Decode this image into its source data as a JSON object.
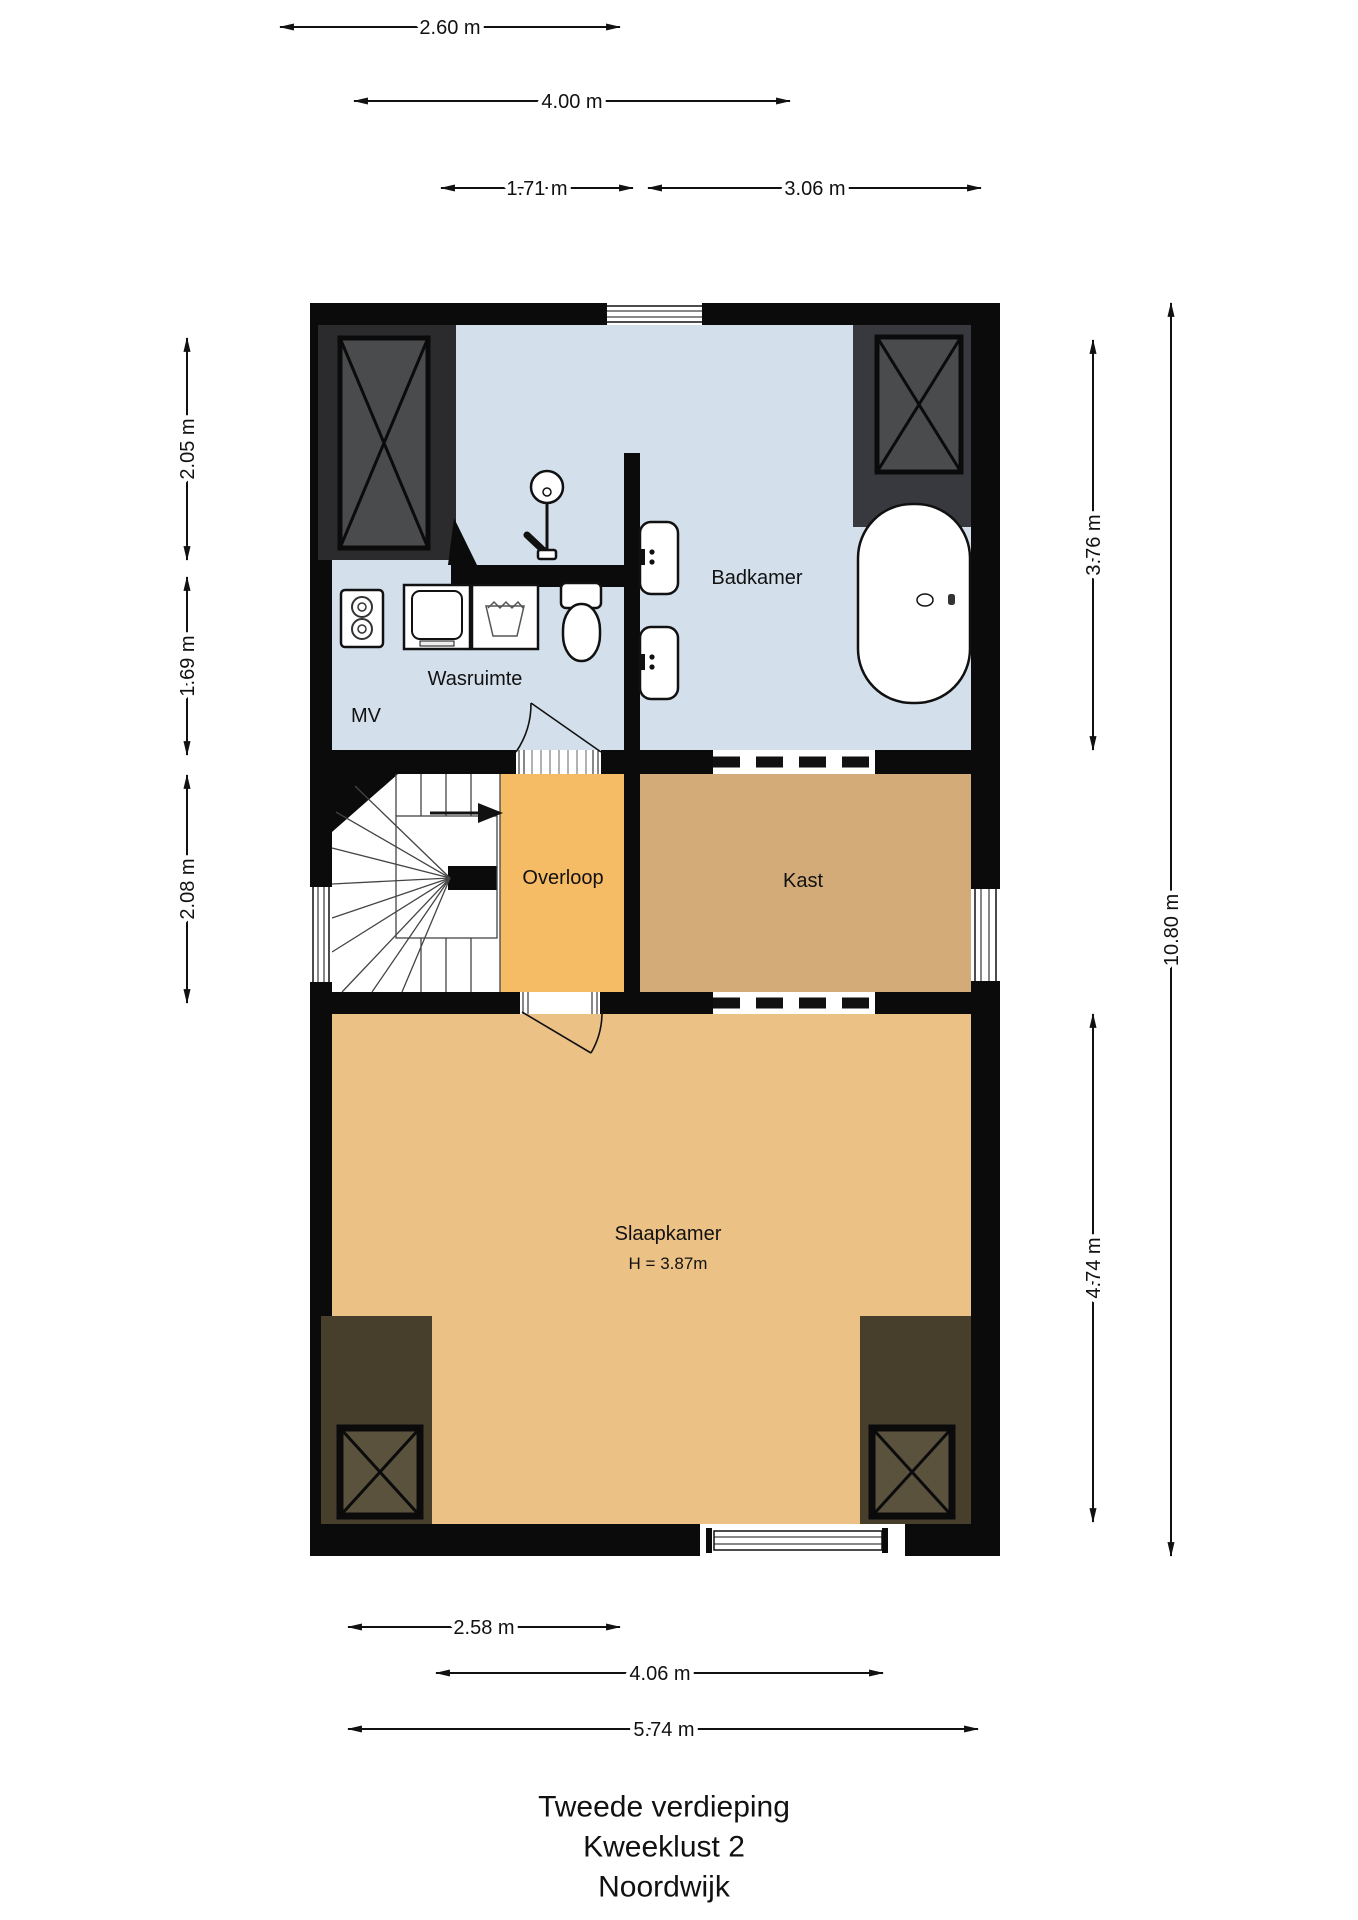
{
  "title": {
    "line1": "Tweede verdieping",
    "line2": "Kweeklust 2",
    "line3": "Noordwijk"
  },
  "rooms": {
    "badkamer": {
      "label": "Badkamer"
    },
    "wasruimte": {
      "label": "Wasruimte"
    },
    "mv": {
      "label": "MV"
    },
    "overloop": {
      "label": "Overloop"
    },
    "kast": {
      "label": "Kast"
    },
    "slaapkamer": {
      "label": "Slaapkamer",
      "height_note": "H = 3.87m"
    }
  },
  "dimensions": {
    "top": [
      {
        "label": "2.60 m"
      },
      {
        "label": "4.00 m"
      },
      {
        "label": "1.71 m"
      },
      {
        "label": "3.06 m"
      }
    ],
    "left": [
      {
        "label": "2.05 m"
      },
      {
        "label": "1.69 m"
      },
      {
        "label": "2.08 m"
      }
    ],
    "right": [
      {
        "label": "3.76 m"
      },
      {
        "label": "10.80 m"
      },
      {
        "label": "4.74 m"
      }
    ],
    "bottom": [
      {
        "label": "2.58 m"
      },
      {
        "label": "4.06 m"
      },
      {
        "label": "5.74 m"
      }
    ]
  },
  "colors": {
    "wall": "#0b0b0b",
    "badkamer": "#d3e0ec",
    "overloop": "#f6bb65",
    "kast": "#d3ab79",
    "slaapkamer": "#ecc186",
    "shaft_top_outer": "#2b2b2e",
    "shaft_top_right_outer": "#37393e",
    "shaft_top_inner": "#4a4b4d",
    "shaft_bottom_outer": "#473f2c",
    "shaft_bottom_inner": "#5a523c"
  }
}
